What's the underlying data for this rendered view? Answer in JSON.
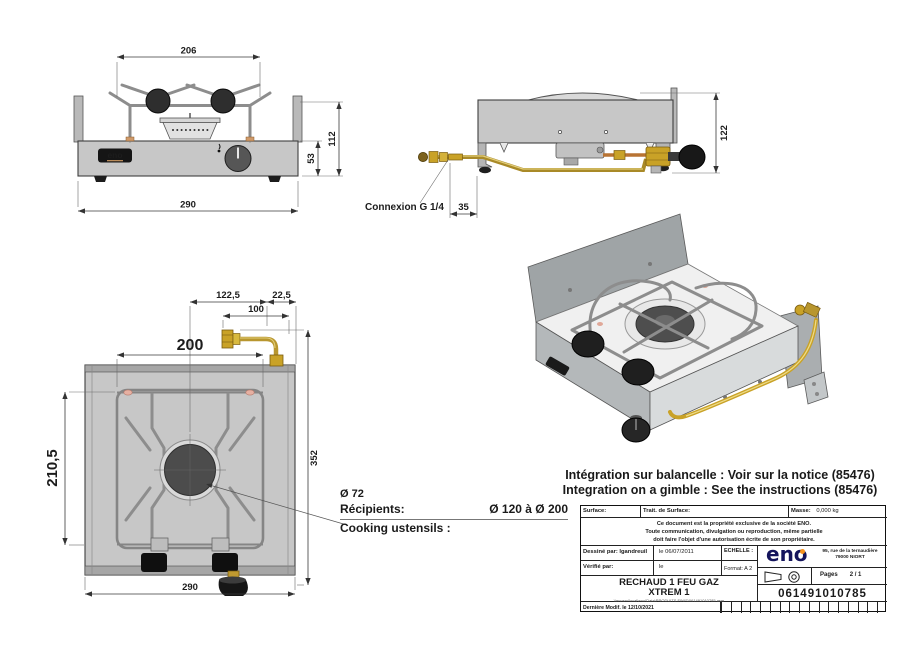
{
  "front_view": {
    "logo": "eno",
    "dim_top_width": "206",
    "dim_bottom_width": "290",
    "dim_total_height": "112",
    "dim_body_height": "53"
  },
  "side_view": {
    "connection_label": "Connexion G 1/4",
    "dim_offset": "35",
    "dim_height": "122"
  },
  "top_view": {
    "dim_center_to_connector": "122,5",
    "dim_connector_to_edge": "22,5",
    "dim_connector_length": "100",
    "dim_support_width": "200",
    "dim_support_depth": "210,5",
    "dim_total_depth": "352",
    "dim_width": "290",
    "burner_diameter": "Ø 72",
    "recipients_label": "Récipients:",
    "recipients_range": "Ø 120 à Ø 200",
    "cooking_label": "Cooking ustensils :"
  },
  "iso_view": {
    "logo": "eno"
  },
  "notes": {
    "integration_fr": "Intégration sur balancelle : Voir sur la notice (85476)",
    "integration_en": "Integration on a gimble : See the instructions (85476)"
  },
  "title_block": {
    "surface_label": "Surface:",
    "surface_treatment_label": "Trait. de Surface:",
    "mass_label": "Masse:",
    "mass_value": "0,000 kg",
    "notice_line1": "Ce document est la propriété exclusive de la société ENO.",
    "notice_line2": "Toute communication, divulgation ou reproduction, même partielle",
    "notice_line3": "doit faire l'objet d'une autorisation écrite de son propriétaire.",
    "drawn_label": "Dessiné par: lgandreuil",
    "drawn_date": "le 06/07/2011",
    "checked_label": "Vérifié par:",
    "checked_date": "le",
    "scale_label": "ECHELLE :",
    "format_label": "Format:  A 2",
    "brand": "eno",
    "address_line1": "95, rue de la ternaudière",
    "address_line2": "79000 NIORT",
    "pages_label": "Pages",
    "pages_value": "2 / 1",
    "title_line1": "RECHAUD 1 FEU GAZ",
    "title_line2": "XTREM 1",
    "file_path": "\\\\enosrv\\local\\eno\\Data\\PRODUITS FINIS\\061491010785.asm",
    "part_number": "061491010785",
    "last_modified": "Dernière Modif. le 12/10/2021"
  }
}
